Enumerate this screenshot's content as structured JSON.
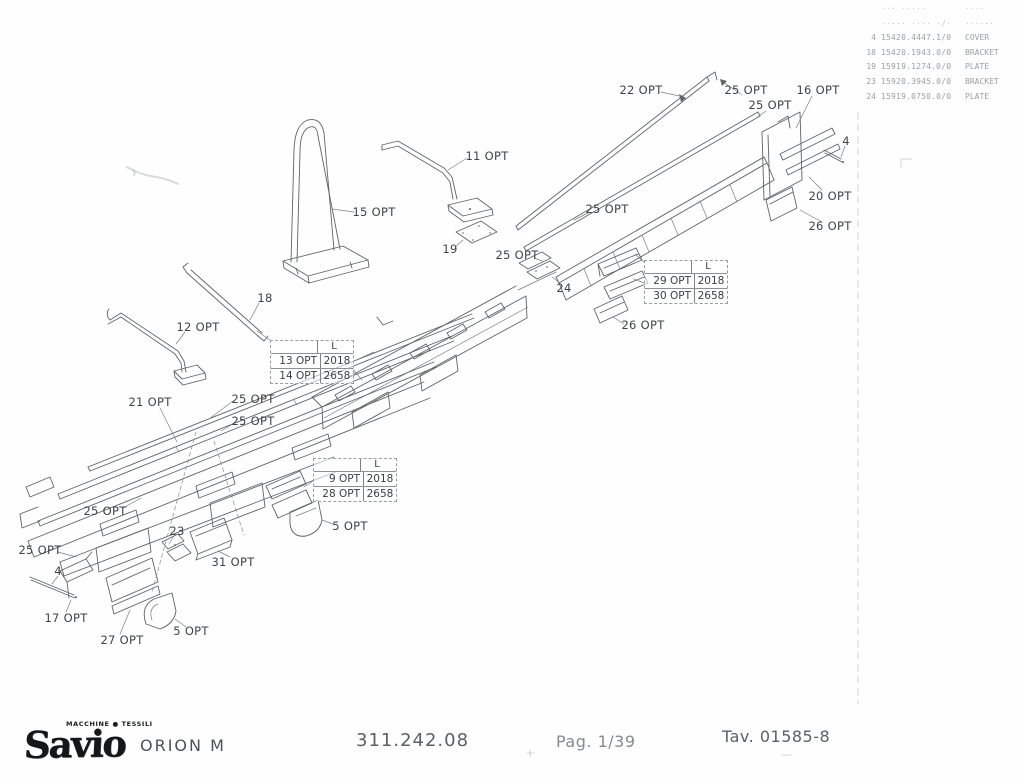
{
  "colors": {
    "ink": "#5f6368",
    "label": "#3f4347",
    "faded": "#9aa0a6"
  },
  "parts_table": {
    "faint_header": {
      "pos": "",
      "code": "··· ·····",
      "desc": "····"
    },
    "faint_row": {
      "pos": "",
      "code": "····· ···· ·/·",
      "desc": "······"
    },
    "rows": [
      {
        "pos": "4",
        "code": "15420.4447.1/0",
        "desc": "COVER"
      },
      {
        "pos": "18",
        "code": "15420.1943.0/0",
        "desc": "BRACKET"
      },
      {
        "pos": "19",
        "code": "15919.1274.0/0",
        "desc": "PLATE"
      },
      {
        "pos": "23",
        "code": "15920.3945.0/0",
        "desc": "BRACKET"
      },
      {
        "pos": "24",
        "code": "15919.0750.0/0",
        "desc": "PLATE"
      }
    ]
  },
  "diagram": {
    "callouts": [
      {
        "text": "22 OPT",
        "x": 641,
        "y": 90
      },
      {
        "text": "25 OPT",
        "x": 746,
        "y": 90
      },
      {
        "text": "16 OPT",
        "x": 818,
        "y": 90
      },
      {
        "text": "25 OPT",
        "x": 770,
        "y": 105
      },
      {
        "text": "4",
        "x": 846,
        "y": 141
      },
      {
        "text": "11 OPT",
        "x": 487,
        "y": 156
      },
      {
        "text": "15 OPT",
        "x": 374,
        "y": 212
      },
      {
        "text": "20 OPT",
        "x": 830,
        "y": 196
      },
      {
        "text": "26 OPT",
        "x": 830,
        "y": 226
      },
      {
        "text": "25 OPT",
        "x": 607,
        "y": 209
      },
      {
        "text": "19",
        "x": 450,
        "y": 249
      },
      {
        "text": "25 OPT",
        "x": 517,
        "y": 255
      },
      {
        "text": "24",
        "x": 564,
        "y": 288
      },
      {
        "text": "18",
        "x": 265,
        "y": 298
      },
      {
        "text": "12 OPT",
        "x": 198,
        "y": 327
      },
      {
        "text": "26 OPT",
        "x": 643,
        "y": 325
      },
      {
        "text": "21 OPT",
        "x": 150,
        "y": 402
      },
      {
        "text": "25 OPT",
        "x": 253,
        "y": 399
      },
      {
        "text": "25 OPT",
        "x": 253,
        "y": 421
      },
      {
        "text": "25 OPT",
        "x": 105,
        "y": 511
      },
      {
        "text": "25 OPT",
        "x": 40,
        "y": 550
      },
      {
        "text": "23",
        "x": 177,
        "y": 531
      },
      {
        "text": "31 OPT",
        "x": 233,
        "y": 562
      },
      {
        "text": "4",
        "x": 58,
        "y": 571
      },
      {
        "text": "17 OPT",
        "x": 66,
        "y": 618
      },
      {
        "text": "27 OPT",
        "x": 122,
        "y": 640
      },
      {
        "text": "5 OPT",
        "x": 191,
        "y": 631
      },
      {
        "text": "5 OPT",
        "x": 350,
        "y": 526
      }
    ],
    "option_boxes": [
      {
        "x": 270,
        "y": 340,
        "header": "L",
        "rows": [
          {
            "label": "13 OPT",
            "value": "2018"
          },
          {
            "label": "14 OPT",
            "value": "2658"
          }
        ]
      },
      {
        "x": 644,
        "y": 260,
        "header": "L",
        "rows": [
          {
            "label": "29 OPT",
            "value": "2018"
          },
          {
            "label": "30 OPT",
            "value": "2658"
          }
        ]
      },
      {
        "x": 313,
        "y": 458,
        "header": "L",
        "rows": [
          {
            "label": "9 OPT",
            "value": "2018"
          },
          {
            "label": "28 OPT",
            "value": "2658"
          }
        ]
      }
    ]
  },
  "footer": {
    "logo_text": "Savio",
    "logo_tagline": "MACCHINE ● TESSILI",
    "model": "ORION M",
    "code": "311.242.08",
    "page": "Pag. 1/39",
    "table_no": "Tav. 01585-8"
  }
}
